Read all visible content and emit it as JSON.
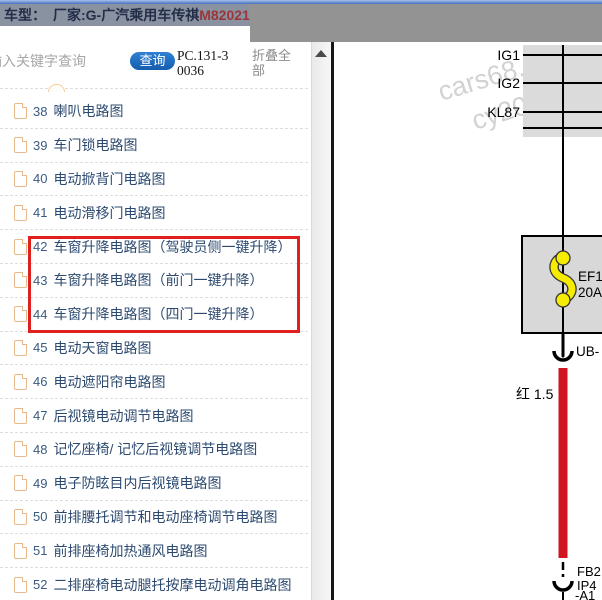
{
  "header": {
    "title_prefix": "车型：　",
    "title_main": "厂家:G-广汽乘用车传祺",
    "title_highlight": "M82021"
  },
  "toolbar": {
    "search_placeholder": "输入关键字查询",
    "search_button": "查询",
    "doc_code": "PC.131-30036",
    "collapse_all": "折叠全部"
  },
  "list": {
    "highlighted_numbers": [
      "42",
      "43",
      "44"
    ],
    "items": [
      {
        "num": "38",
        "label": "喇叭电路图"
      },
      {
        "num": "39",
        "label": "车门锁电路图"
      },
      {
        "num": "40",
        "label": "电动掀背门电路图"
      },
      {
        "num": "41",
        "label": "电动滑移门电路图"
      },
      {
        "num": "42",
        "label": "车窗升降电路图（驾驶员侧一键升降）"
      },
      {
        "num": "43",
        "label": "车窗升降电路图（前门一键升降）"
      },
      {
        "num": "44",
        "label": "车窗升降电路图（四门一键升降）"
      },
      {
        "num": "45",
        "label": "电动天窗电路图"
      },
      {
        "num": "46",
        "label": "电动遮阳帘电路图"
      },
      {
        "num": "47",
        "label": "后视镜电动调节电路图"
      },
      {
        "num": "48",
        "label": "记忆座椅/ 记忆后视镜调节电路图"
      },
      {
        "num": "49",
        "label": "电子防眩目内后视镜电路图"
      },
      {
        "num": "50",
        "label": "前排腰托调节和电动座椅调节电路图"
      },
      {
        "num": "51",
        "label": "前排座椅加热通风电路图"
      },
      {
        "num": "52",
        "label": "二排座椅电动腿托按摩电动调角电路图"
      }
    ]
  },
  "diagram": {
    "bus_labels": {
      "ig1": "IG1",
      "ig2": "IG2",
      "kl87": "KL87"
    },
    "fuse": {
      "name": "EF1",
      "rating": "20A"
    },
    "connector_top_label": "UB-",
    "wire_label": "红 1.5",
    "connector_bottom": {
      "line1": "FB2",
      "line2": "IP4",
      "line3": "-A1"
    },
    "watermark": {
      "line1": "cars68.co",
      "line2": "cy20165"
    }
  },
  "colors": {
    "highlight_box": "#e01f1f",
    "wire_red": "#cf1620",
    "fuse_yellow": "#f5ec00",
    "button_blue": "#1e6fc4",
    "title_highlight": "#9c3537"
  },
  "icons": {
    "list_item_icon": "document-icon",
    "scroll_up_icon": "up-triangle-icon"
  }
}
